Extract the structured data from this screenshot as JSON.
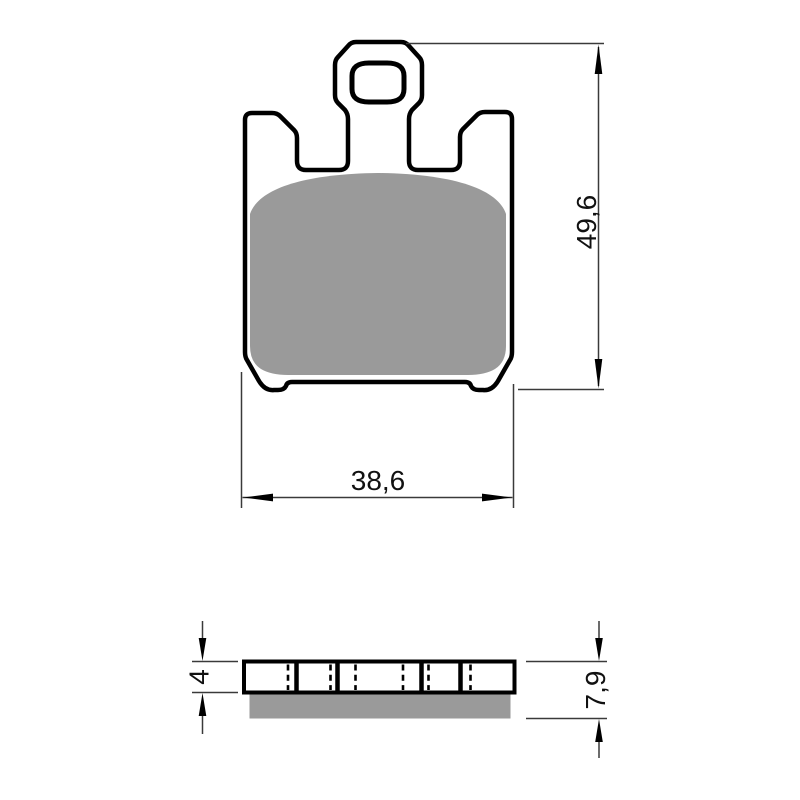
{
  "drawing": {
    "top_view": {
      "height_dim": "49,6",
      "width_dim": "38,6"
    },
    "side_view": {
      "plate_thickness_dim": "4",
      "overall_thickness_dim": "7,9"
    }
  },
  "colors": {
    "outline": "#000000",
    "friction": "#9a9a9a",
    "dimline": "#3a3a3a",
    "textcolor": "#111111",
    "bg": "#ffffff"
  }
}
